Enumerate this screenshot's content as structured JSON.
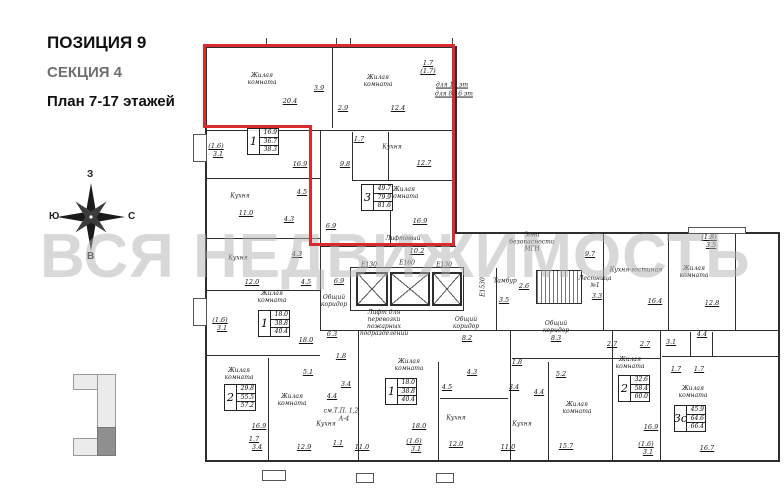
{
  "header": {
    "position": "ПОЗИЦИЯ 9",
    "section": "СЕКЦИЯ 4",
    "plan_title": "План 7-17 этажей"
  },
  "watermark": "ВСЯ НЕДВИЖИМОСТЬ",
  "compass": {
    "top": "З",
    "right": "С",
    "bottom": "В",
    "left": "Ю"
  },
  "colors": {
    "highlight": "#d92b2b",
    "wall": "#2e2e2e",
    "watermark": "#b2b2b2"
  },
  "plan": {
    "room_labels": [
      {
        "t": "Жилая\nкомната",
        "x": 262,
        "y": 80
      },
      {
        "t": "Жилая\nкомната",
        "x": 378,
        "y": 82
      },
      {
        "t": "Кухня",
        "x": 392,
        "y": 148
      },
      {
        "t": "Кухня",
        "x": 240,
        "y": 197
      },
      {
        "t": "Жилая\nкомната",
        "x": 404,
        "y": 194
      },
      {
        "t": "Кухня",
        "x": 238,
        "y": 259
      },
      {
        "t": "Жилая\nкомната",
        "x": 272,
        "y": 298
      },
      {
        "t": "Общий\nкоридор",
        "x": 334,
        "y": 302
      },
      {
        "t": "Лифтовый\nхолл",
        "x": 403,
        "y": 243
      },
      {
        "t": "Лифт для\nперевозки\nпожарных\nподразделений",
        "x": 384,
        "y": 324
      },
      {
        "t": "Тамбур",
        "x": 505,
        "y": 282
      },
      {
        "t": "Зона\nбезопасности\nМГН",
        "x": 532,
        "y": 243
      },
      {
        "t": "Лестница\n№1",
        "x": 595,
        "y": 283
      },
      {
        "t": "Общий\nкоридор",
        "x": 466,
        "y": 324
      },
      {
        "t": "Общий\nкоридор",
        "x": 556,
        "y": 328
      },
      {
        "t": "Кухня-гостиная",
        "x": 636,
        "y": 271
      },
      {
        "t": "Жилая\nкомната",
        "x": 694,
        "y": 273
      },
      {
        "t": "Жилая\nкомната",
        "x": 239,
        "y": 375
      },
      {
        "t": "Жилая\nкомната",
        "x": 292,
        "y": 401
      },
      {
        "t": "Кухня",
        "x": 326,
        "y": 425
      },
      {
        "t": "Жилая\nкомната",
        "x": 409,
        "y": 366
      },
      {
        "t": "Кухня",
        "x": 456,
        "y": 419
      },
      {
        "t": "Кухня",
        "x": 522,
        "y": 425
      },
      {
        "t": "Жилая\nкомната",
        "x": 577,
        "y": 409
      },
      {
        "t": "Жилая\nкомната",
        "x": 630,
        "y": 364
      },
      {
        "t": "Жилая\nкомната",
        "x": 693,
        "y": 393
      },
      {
        "t": "для 17 эт",
        "x": 452,
        "y": 86,
        "u": true
      },
      {
        "t": "для 8-16 эт",
        "x": 454,
        "y": 95,
        "u": true
      },
      {
        "t": "Е1530",
        "x": 484,
        "y": 287,
        "rot": -90
      },
      {
        "t": "см.Т.П. 1,2",
        "x": 341,
        "y": 412
      },
      {
        "t": "А-4",
        "x": 344,
        "y": 420
      }
    ],
    "numbers": [
      {
        "t": "20.4",
        "x": 290,
        "y": 101
      },
      {
        "t": "3.9",
        "x": 319,
        "y": 88
      },
      {
        "t": "2.9",
        "x": 343,
        "y": 108
      },
      {
        "t": "12.4",
        "x": 398,
        "y": 108
      },
      {
        "t": "1.7",
        "x": 359,
        "y": 139
      },
      {
        "t": "12.7",
        "x": 424,
        "y": 163
      },
      {
        "t": "9.8",
        "x": 345,
        "y": 164
      },
      {
        "t": "16.9",
        "x": 300,
        "y": 164
      },
      {
        "t": "1.7",
        "x": 428,
        "y": 63
      },
      {
        "t": "(1.7)",
        "x": 428,
        "y": 71
      },
      {
        "t": "(1.6)",
        "x": 216,
        "y": 146
      },
      {
        "t": "3.1",
        "x": 218,
        "y": 154
      },
      {
        "t": "4.5",
        "x": 302,
        "y": 192
      },
      {
        "t": "11.0",
        "x": 246,
        "y": 213
      },
      {
        "t": "4.3",
        "x": 289,
        "y": 219
      },
      {
        "t": "6.9",
        "x": 331,
        "y": 226
      },
      {
        "t": "16.9",
        "x": 420,
        "y": 221
      },
      {
        "t": "4.3",
        "x": 297,
        "y": 254
      },
      {
        "t": "12.0",
        "x": 252,
        "y": 282
      },
      {
        "t": "4.5",
        "x": 306,
        "y": 282
      },
      {
        "t": "6.9",
        "x": 339,
        "y": 281
      },
      {
        "t": "(1.6)",
        "x": 220,
        "y": 320
      },
      {
        "t": "3.1",
        "x": 222,
        "y": 328
      },
      {
        "t": "18.0",
        "x": 306,
        "y": 340
      },
      {
        "t": "6.3",
        "x": 332,
        "y": 334
      },
      {
        "t": "10.2",
        "x": 417,
        "y": 251
      },
      {
        "t": "2.6",
        "x": 524,
        "y": 286
      },
      {
        "t": "3.5",
        "x": 504,
        "y": 300
      },
      {
        "t": "9.7",
        "x": 590,
        "y": 254
      },
      {
        "t": "3.3",
        "x": 597,
        "y": 296
      },
      {
        "t": "8.2",
        "x": 467,
        "y": 338
      },
      {
        "t": "8.3",
        "x": 556,
        "y": 338
      },
      {
        "t": "2.7",
        "x": 612,
        "y": 344
      },
      {
        "t": "16.4",
        "x": 655,
        "y": 301
      },
      {
        "t": "12.8",
        "x": 712,
        "y": 303
      },
      {
        "t": "(1.8)",
        "x": 709,
        "y": 237
      },
      {
        "t": "3.5",
        "x": 711,
        "y": 245
      },
      {
        "t": "4.4",
        "x": 702,
        "y": 334
      },
      {
        "t": "2.7",
        "x": 645,
        "y": 344
      },
      {
        "t": "3.1",
        "x": 671,
        "y": 342
      },
      {
        "t": "5.1",
        "x": 308,
        "y": 372
      },
      {
        "t": "16.9",
        "x": 259,
        "y": 426
      },
      {
        "t": "1.7",
        "x": 254,
        "y": 439
      },
      {
        "t": "3.4",
        "x": 257,
        "y": 447
      },
      {
        "t": "12.9",
        "x": 304,
        "y": 447
      },
      {
        "t": "3.4",
        "x": 346,
        "y": 384
      },
      {
        "t": "4.4",
        "x": 332,
        "y": 396
      },
      {
        "t": "1.1",
        "x": 338,
        "y": 443
      },
      {
        "t": "1.8",
        "x": 341,
        "y": 356
      },
      {
        "t": "11.0",
        "x": 362,
        "y": 447
      },
      {
        "t": "4.3",
        "x": 472,
        "y": 372
      },
      {
        "t": "4.5",
        "x": 447,
        "y": 387
      },
      {
        "t": "18.0",
        "x": 419,
        "y": 426
      },
      {
        "t": "12.0",
        "x": 456,
        "y": 444
      },
      {
        "t": "(1.6)",
        "x": 414,
        "y": 441
      },
      {
        "t": "3.1",
        "x": 416,
        "y": 449
      },
      {
        "t": "11.0",
        "x": 508,
        "y": 447
      },
      {
        "t": "1.8",
        "x": 517,
        "y": 362
      },
      {
        "t": "3.4",
        "x": 514,
        "y": 387
      },
      {
        "t": "5.2",
        "x": 561,
        "y": 374
      },
      {
        "t": "4.4",
        "x": 539,
        "y": 392
      },
      {
        "t": "15.7",
        "x": 566,
        "y": 446
      },
      {
        "t": "16.9",
        "x": 651,
        "y": 427
      },
      {
        "t": "(1.6)",
        "x": 646,
        "y": 444
      },
      {
        "t": "3.1",
        "x": 648,
        "y": 452
      },
      {
        "t": "1.7",
        "x": 676,
        "y": 369
      },
      {
        "t": "1.7",
        "x": 699,
        "y": 369
      },
      {
        "t": "16.7",
        "x": 707,
        "y": 448
      }
    ],
    "apartments": [
      {
        "n": "1",
        "a": "16.9",
        "b": "36.7",
        "c": "38.3",
        "x": 247,
        "y": 128
      },
      {
        "n": "3",
        "a": "49.7",
        "b": "79.9",
        "c": "81.6",
        "x": 361,
        "y": 184
      },
      {
        "n": "1",
        "a": "18.0",
        "b": "38.8",
        "c": "40.4",
        "x": 258,
        "y": 310
      },
      {
        "n": "2",
        "a": "29.8",
        "b": "55.5",
        "c": "57.2",
        "x": 224,
        "y": 384
      },
      {
        "n": "1",
        "a": "18.0",
        "b": "38.8",
        "c": "40.4",
        "x": 385,
        "y": 378
      },
      {
        "n": "2",
        "a": "32.6",
        "b": "58.4",
        "c": "60.0",
        "x": 618,
        "y": 375
      },
      {
        "n": "3с",
        "a": "45.9",
        "b": "64.6",
        "c": "66.4",
        "x": 674,
        "y": 405
      }
    ],
    "shaft_labels": [
      {
        "t": "Е130",
        "x": 369,
        "y": 265
      },
      {
        "t": "Е160",
        "x": 407,
        "y": 263
      },
      {
        "t": "Е130",
        "x": 444,
        "y": 265
      }
    ],
    "shafts": [
      [
        356,
        272,
        28,
        30
      ],
      [
        390,
        272,
        36,
        30
      ],
      [
        432,
        272,
        26,
        30
      ]
    ],
    "boxes": [
      [
        350,
        267,
        112,
        42
      ]
    ],
    "stairs": [
      536,
      270,
      44,
      32
    ],
    "walls": [
      [
        205,
        46,
        252,
        2
      ],
      [
        205,
        46,
        2,
        416
      ],
      [
        455,
        46,
        2,
        188
      ],
      [
        455,
        232,
        325,
        2
      ],
      [
        778,
        232,
        2,
        230
      ],
      [
        205,
        460,
        575,
        2
      ],
      [
        320,
        330,
        460,
        1
      ],
      [
        207,
        355,
        113,
        1
      ],
      [
        332,
        48,
        1,
        80
      ],
      [
        207,
        130,
        249,
        1
      ],
      [
        320,
        130,
        1,
        200
      ],
      [
        207,
        178,
        113,
        1
      ],
      [
        207,
        238,
        113,
        1
      ],
      [
        207,
        290,
        113,
        1
      ],
      [
        352,
        132,
        1,
        48
      ],
      [
        388,
        132,
        1,
        48
      ],
      [
        352,
        180,
        103,
        1
      ],
      [
        390,
        192,
        1,
        52
      ],
      [
        320,
        246,
        136,
        1
      ],
      [
        603,
        234,
        1,
        96
      ],
      [
        668,
        234,
        1,
        96
      ],
      [
        735,
        234,
        1,
        96
      ],
      [
        358,
        330,
        1,
        130
      ],
      [
        510,
        330,
        1,
        130
      ],
      [
        660,
        330,
        1,
        130
      ],
      [
        268,
        358,
        1,
        102
      ],
      [
        438,
        362,
        1,
        98
      ],
      [
        548,
        362,
        1,
        98
      ],
      [
        612,
        330,
        1,
        130
      ],
      [
        662,
        356,
        116,
        1
      ],
      [
        690,
        332,
        1,
        24
      ],
      [
        712,
        332,
        1,
        24
      ],
      [
        440,
        398,
        68,
        1
      ],
      [
        512,
        358,
        148,
        1
      ],
      [
        496,
        268,
        1,
        62
      ]
    ],
    "balconies": [
      [
        193,
        134,
        12,
        26
      ],
      [
        193,
        298,
        12,
        26
      ],
      [
        688,
        227,
        56,
        5
      ],
      [
        262,
        470,
        22,
        9
      ],
      [
        356,
        473,
        16,
        8
      ],
      [
        436,
        473,
        16,
        8
      ]
    ],
    "ticks": [
      [
        266,
        38,
        1,
        9
      ],
      [
        336,
        38,
        1,
        9
      ],
      [
        350,
        38,
        1,
        9
      ],
      [
        452,
        38,
        1,
        9
      ]
    ],
    "red_outline": [
      [
        203,
        44,
        252,
        3
      ],
      [
        452,
        44,
        3,
        202
      ],
      [
        309,
        243,
        146,
        3
      ],
      [
        309,
        125,
        3,
        121
      ],
      [
        203,
        125,
        109,
        3
      ],
      [
        203,
        44,
        3,
        84
      ]
    ]
  }
}
